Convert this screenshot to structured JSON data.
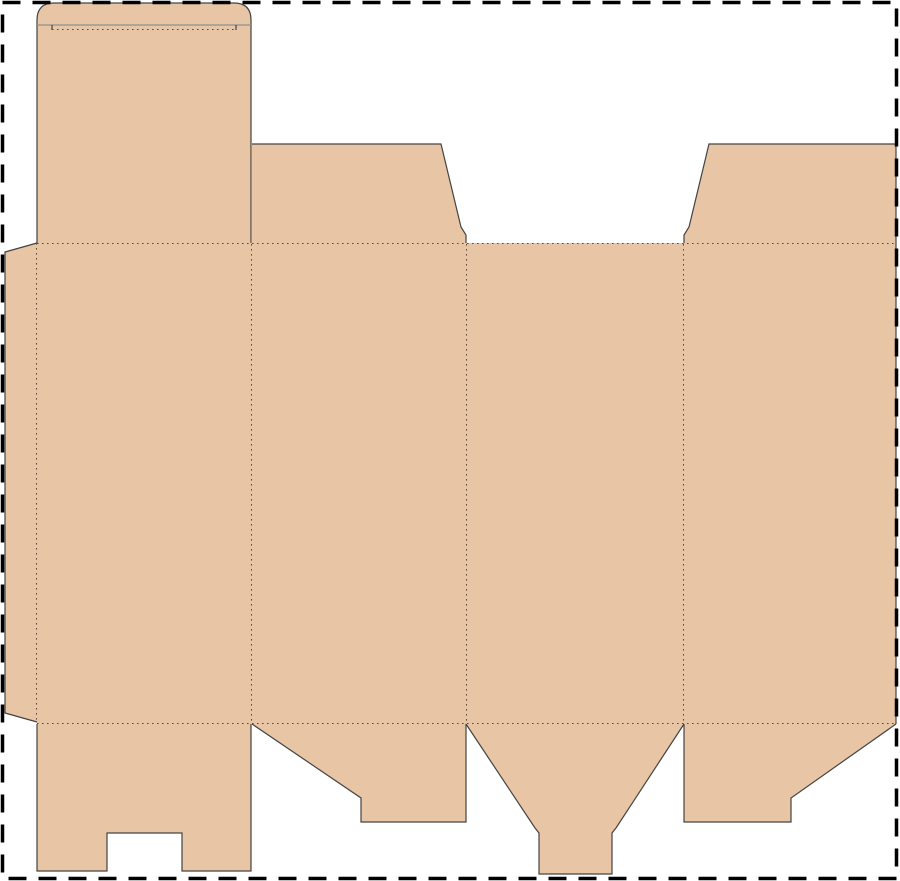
{
  "document": {
    "type": "packaging-dieline",
    "description": "Flattened folding-carton box template (dieline) with tuck lid, glue flap, side/back panels and bottom closure flaps",
    "background_color": "#ffffff"
  },
  "board": {
    "fill_color": "#e8c5a4",
    "cut_line_color": "#434343",
    "soft_line_color": "#8f8f8f",
    "crease_line_color": "#5f4a38",
    "crease_dash": "1.6 3.4",
    "cut_width": 1.2,
    "crease_width": 1
  },
  "frame": {
    "color": "#000000",
    "dash": "18 12",
    "width": 3.5,
    "x": 2.5,
    "y": 2.5,
    "w": 894,
    "h": 876
  },
  "panels": [
    {
      "name": "lid-tuck-panel",
      "path": "M 37 243 L 37 20 Q 37 3 54 3 L 234 3 Q 251 3 251 20 L 251 243 Z"
    },
    {
      "name": "top-flap-left",
      "path": "M 252 144 L 441 144 L 461 227 L 466 235 L 466 243 L 252 243 Z"
    },
    {
      "name": "top-flap-right",
      "path": "M 709 144 L 896 144 L 896 243 L 684 243 L 684 235 L 689 227 Z"
    },
    {
      "name": "glue-flap",
      "path": "M 37 243 L 5 252 L 5 713 L 37 722 Z"
    },
    {
      "name": "main-body-panels",
      "path": "M 37 243 L 896 243 L 896 724 L 37 724 Z"
    },
    {
      "name": "bottom-flap-slotted",
      "path": "M 37 724 L 251 724 L 251 871 L 182 871 L 182 833 L 107 833 L 107 871 L 37 871 Z"
    },
    {
      "name": "bottom-flap-step-left",
      "path": "M 252 724 L 466 724 L 466 822 L 361 822 L 361 798 Z"
    },
    {
      "name": "bottom-flap-tongue",
      "path": "M 466 724 L 684 724 L 616 828 L 612 833 L 612 874 L 539 874 L 539 833 L 535 828 Z"
    },
    {
      "name": "bottom-flap-step-right",
      "path": "M 684 724 L 896 724 L 791 798 L 791 822 L 684 822 Z"
    }
  ],
  "cuts": [
    {
      "name": "lid-outline-cut",
      "d": "M 37 243 L 37 20 Q 37 3 54 3 L 234 3 Q 251 3 251 20 L 251 243"
    },
    {
      "name": "lid-shoulder-line",
      "d": "M 37 25 L 251 25",
      "soft": true
    },
    {
      "name": "lid-shoulder-nick-left",
      "d": "M 52 25 L 52 30"
    },
    {
      "name": "lid-shoulder-nick-right",
      "d": "M 236 25 L 236 30"
    },
    {
      "name": "top-flap-left-cut",
      "d": "M 252 144 L 441 144 L 461 227 L 466 235 L 466 243"
    },
    {
      "name": "top-flap-right-cut",
      "d": "M 684 243 L 684 235 L 689 227 L 709 144 L 896 144"
    },
    {
      "name": "sheet-right-edge-cut",
      "d": "M 896 144 L 896 724"
    },
    {
      "name": "glue-flap-cut",
      "d": "M 37 243 L 5 252 L 5 713 L 37 722"
    },
    {
      "name": "bottom-flap-slotted-cut",
      "d": "M 37 724 L 37 871 L 107 871 L 107 833 L 182 833 L 182 871 L 251 871 L 251 724"
    },
    {
      "name": "bottom-flap-step-left-cut",
      "d": "M 252 724 L 361 798 L 361 822 L 466 822 L 466 724"
    },
    {
      "name": "bottom-flap-tongue-cut",
      "d": "M 466 724 L 535 828 L 539 833 L 539 874 L 612 874 L 612 833 L 616 828 L 684 724"
    },
    {
      "name": "bottom-flap-step-right-cut",
      "d": "M 684 724 L 684 822 L 791 822 L 791 798 L 896 724"
    }
  ],
  "creases": [
    {
      "name": "lid-tuck-crease",
      "d": "M 52 29.5 L 236 29.5"
    },
    {
      "name": "top-fold-crease",
      "d": "M 37 243.5 L 896 243.5"
    },
    {
      "name": "bottom-fold-crease",
      "d": "M 37 723.5 L 896 723.5"
    },
    {
      "name": "glue-flap-crease",
      "d": "M 36.5 243 L 36.5 722"
    },
    {
      "name": "panel-crease-1",
      "d": "M 251.5 244 L 251.5 724"
    },
    {
      "name": "panel-crease-2",
      "d": "M 466.5 244 L 466.5 724"
    },
    {
      "name": "panel-crease-3",
      "d": "M 683.5 244 L 683.5 724"
    }
  ]
}
